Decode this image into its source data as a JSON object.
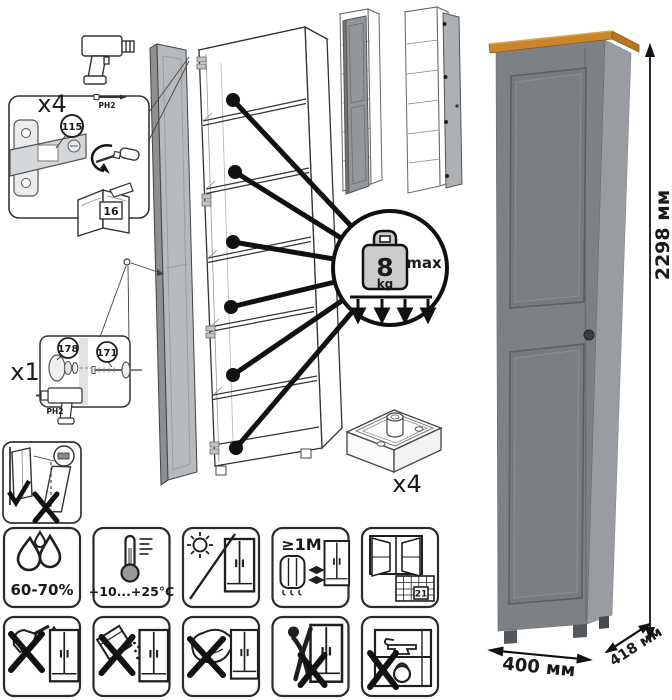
{
  "document": {
    "type": "furniture-assembly-and-care-sheet"
  },
  "callouts": {
    "hinges": {
      "qty": "x4",
      "part": "115",
      "bit": "PH2",
      "manual_page": "16"
    },
    "handle": {
      "qty": "x1",
      "knob_part": "178",
      "screw_part": "171",
      "bit": "PH2"
    },
    "shelf_load": {
      "value": "8",
      "unit": "kg",
      "qualifier": "max"
    },
    "feet": {
      "qty": "x4"
    }
  },
  "care": {
    "humidity": {
      "icon": "water-drops",
      "label": "60-70%"
    },
    "temperature": {
      "icon": "thermometer",
      "label": "+10...+25°C"
    },
    "sunlight": {
      "icon": "no-direct-sunlight"
    },
    "heat_distance": {
      "icon": "radiator-distance",
      "label": "≥1M"
    },
    "ventilation": {
      "icon": "open-window-calendar",
      "calendar_day": "21"
    },
    "prohibitions": [
      {
        "icon": "no-solvents"
      },
      {
        "icon": "no-abrasive-powder"
      },
      {
        "icon": "no-scouring-sponge"
      },
      {
        "icon": "no-climbing-pulling"
      },
      {
        "icon": "no-heavy-items"
      }
    ]
  },
  "dimensions": {
    "height": "2298 мм",
    "width": "400 мм",
    "depth": "418 мм"
  },
  "colors": {
    "cabinet_front": "#7d8084",
    "cabinet_side": "#999ca0",
    "top_board_oak": "#c8872e",
    "drawing_door_gray": "#b7babc",
    "weight_gray": "#cccccc",
    "line": "#1a1a1a"
  }
}
